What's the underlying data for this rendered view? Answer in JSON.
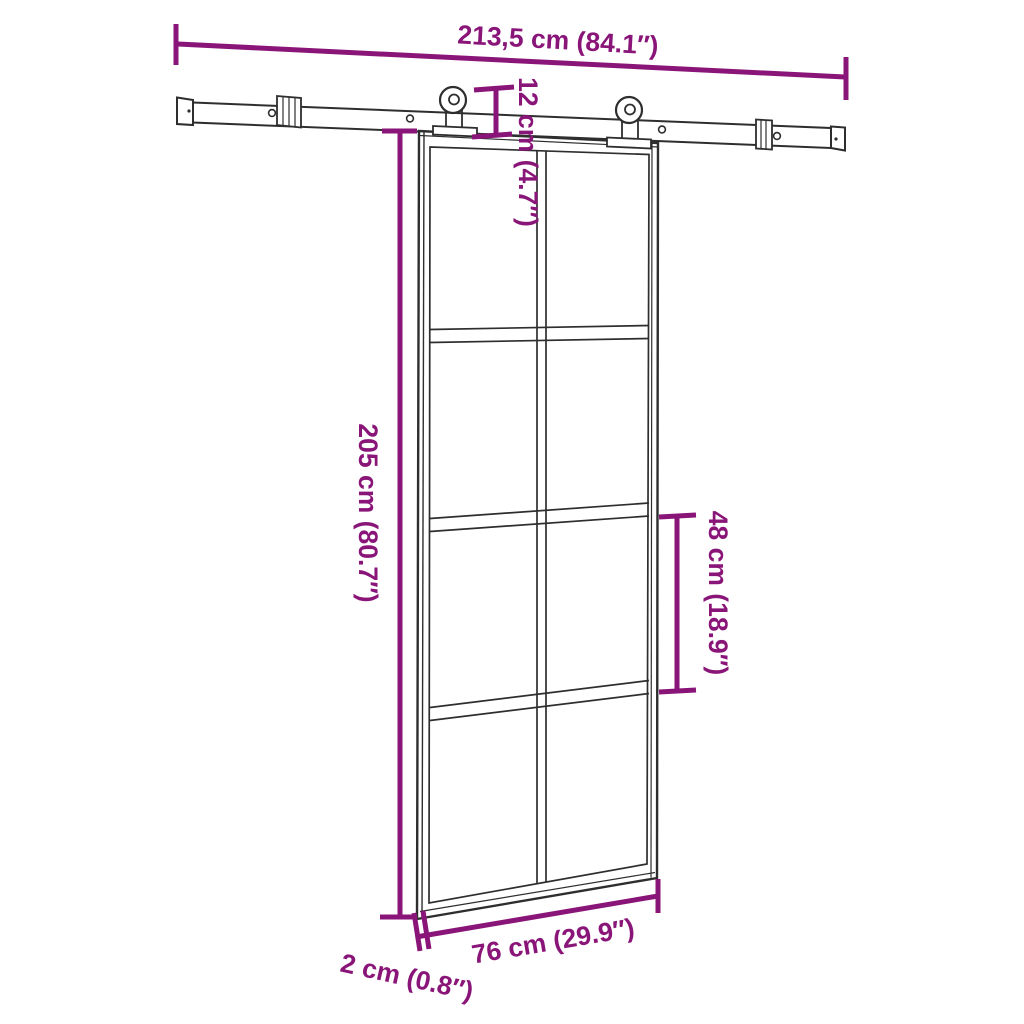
{
  "diagram": {
    "kind": "product-dimension-diagram",
    "subject": "sliding barn door with top rail hardware, 2x4 glass panel grid"
  },
  "dimensions": {
    "rail_width": "213,5 cm (84.1″)",
    "top_offset": "12 cm (4.7″)",
    "door_height": "205 cm (80.7″)",
    "section_height": "48 cm (18.9″)",
    "door_width": "76 cm (29.9″)",
    "door_thickness": "2 cm (0.8″)"
  },
  "colors": {
    "dimension_accent": "#8a1578",
    "line_art": "#2e2e2e",
    "background": "#ffffff"
  }
}
